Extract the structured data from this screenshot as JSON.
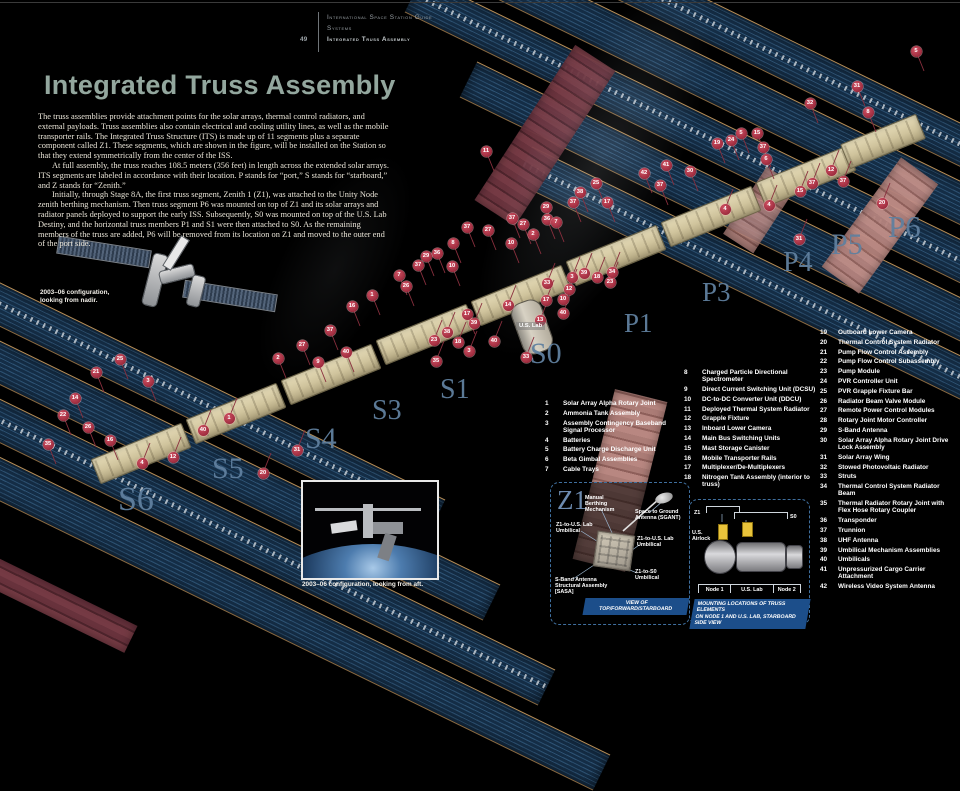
{
  "header": {
    "guide": "International Space Station Guide",
    "section": "Systems",
    "chapter": "Integrated Truss Assembly",
    "page": "49"
  },
  "title": "Integrated Truss Assembly",
  "intro": {
    "p1": "The truss assemblies provide attachment points for the solar arrays, thermal control radiators, and external payloads. Truss assemblies also contain electrical and cooling utility lines, as well as the mobile transporter rails. The Integrated Truss Structure (ITS) is made up of 11 segments plus a separate component called Z1. These segments, which are shown in the figure, will be installed on the Station so that they extend symmetrically from the center of the ISS.",
    "p2": "At full assembly, the truss reaches 108.5 meters (356 feet) in length across the extended solar arrays. ITS segments are labeled in accordance with their location. P stands for “port,” S stands for “starboard,” and Z stands for “Zenith.”",
    "p3": "Initially, through Stage 8A, the first truss segment, Zenith 1 (Z1), was attached to the Unity Node zenith berthing mechanism. Then truss segment P6 was mounted on top of Z1 and its solar arrays and radiator panels deployed to support the early ISS. Subsequently, S0 was mounted on top of the U.S. Lab Destiny, and the horizontal truss members P1 and S1 were then attached to S0. As the remaining members of the truss are added, P6 will be removed from its location on Z1 and moved to the outer end of the port side.",
    "caption_nadir": "2003–06 configuration, looking from nadir.",
    "caption_aft": "2003–06 configuration, looking from aft."
  },
  "diagram": {
    "us_lab_tag": "U.S. Lab",
    "segment_labels": [
      {
        "text": "S6",
        "x": 118,
        "y": 481,
        "size": 34
      },
      {
        "text": "S5",
        "x": 212,
        "y": 452,
        "size": 30
      },
      {
        "text": "S4",
        "x": 305,
        "y": 422,
        "size": 30
      },
      {
        "text": "S3",
        "x": 372,
        "y": 395,
        "size": 28
      },
      {
        "text": "S1",
        "x": 440,
        "y": 374,
        "size": 28
      },
      {
        "text": "S0",
        "x": 530,
        "y": 337,
        "size": 30
      },
      {
        "text": "P1",
        "x": 624,
        "y": 308,
        "size": 27
      },
      {
        "text": "P3",
        "x": 702,
        "y": 277,
        "size": 27
      },
      {
        "text": "P4",
        "x": 783,
        "y": 247,
        "size": 28
      },
      {
        "text": "P5",
        "x": 831,
        "y": 228,
        "size": 30
      },
      {
        "text": "P6",
        "x": 888,
        "y": 209,
        "size": 31
      }
    ],
    "badges": [
      {
        "n": "5",
        "x": 916,
        "y": 51
      },
      {
        "n": "31",
        "x": 857,
        "y": 86
      },
      {
        "n": "8",
        "x": 868,
        "y": 112
      },
      {
        "n": "32",
        "x": 810,
        "y": 103
      },
      {
        "n": "20",
        "x": 882,
        "y": 203
      },
      {
        "n": "37",
        "x": 843,
        "y": 181
      },
      {
        "n": "37",
        "x": 812,
        "y": 183
      },
      {
        "n": "15",
        "x": 800,
        "y": 191
      },
      {
        "n": "4",
        "x": 769,
        "y": 205
      },
      {
        "n": "31",
        "x": 799,
        "y": 239
      },
      {
        "n": "12",
        "x": 831,
        "y": 170
      },
      {
        "n": "15",
        "x": 757,
        "y": 133
      },
      {
        "n": "5",
        "x": 741,
        "y": 133
      },
      {
        "n": "24",
        "x": 731,
        "y": 140
      },
      {
        "n": "19",
        "x": 717,
        "y": 143
      },
      {
        "n": "37",
        "x": 763,
        "y": 147
      },
      {
        "n": "6",
        "x": 766,
        "y": 159
      },
      {
        "n": "30",
        "x": 690,
        "y": 171
      },
      {
        "n": "41",
        "x": 666,
        "y": 165
      },
      {
        "n": "42",
        "x": 644,
        "y": 173
      },
      {
        "n": "37",
        "x": 660,
        "y": 185
      },
      {
        "n": "4",
        "x": 725,
        "y": 209
      },
      {
        "n": "11",
        "x": 486,
        "y": 151
      },
      {
        "n": "25",
        "x": 596,
        "y": 183
      },
      {
        "n": "38",
        "x": 580,
        "y": 192
      },
      {
        "n": "37",
        "x": 573,
        "y": 202
      },
      {
        "n": "17",
        "x": 607,
        "y": 202
      },
      {
        "n": "29",
        "x": 546,
        "y": 207
      },
      {
        "n": "36",
        "x": 547,
        "y": 219
      },
      {
        "n": "7",
        "x": 556,
        "y": 222
      },
      {
        "n": "2",
        "x": 533,
        "y": 234
      },
      {
        "n": "27",
        "x": 523,
        "y": 224
      },
      {
        "n": "37",
        "x": 512,
        "y": 218
      },
      {
        "n": "10",
        "x": 511,
        "y": 243
      },
      {
        "n": "27",
        "x": 488,
        "y": 230
      },
      {
        "n": "37",
        "x": 467,
        "y": 227
      },
      {
        "n": "8",
        "x": 453,
        "y": 243
      },
      {
        "n": "36",
        "x": 437,
        "y": 253
      },
      {
        "n": "29",
        "x": 426,
        "y": 256
      },
      {
        "n": "10",
        "x": 452,
        "y": 266
      },
      {
        "n": "37",
        "x": 418,
        "y": 265
      },
      {
        "n": "7",
        "x": 399,
        "y": 275
      },
      {
        "n": "3",
        "x": 572,
        "y": 277
      },
      {
        "n": "39",
        "x": 584,
        "y": 273
      },
      {
        "n": "18",
        "x": 597,
        "y": 277
      },
      {
        "n": "23",
        "x": 610,
        "y": 282
      },
      {
        "n": "34",
        "x": 612,
        "y": 272
      },
      {
        "n": "12",
        "x": 569,
        "y": 289
      },
      {
        "n": "33",
        "x": 547,
        "y": 283
      },
      {
        "n": "14",
        "x": 508,
        "y": 305
      },
      {
        "n": "17",
        "x": 546,
        "y": 300
      },
      {
        "n": "10",
        "x": 563,
        "y": 299
      },
      {
        "n": "40",
        "x": 563,
        "y": 313
      },
      {
        "n": "17",
        "x": 467,
        "y": 314
      },
      {
        "n": "39",
        "x": 474,
        "y": 323
      },
      {
        "n": "38",
        "x": 447,
        "y": 332
      },
      {
        "n": "23",
        "x": 434,
        "y": 340
      },
      {
        "n": "18",
        "x": 458,
        "y": 342
      },
      {
        "n": "3",
        "x": 469,
        "y": 351
      },
      {
        "n": "35",
        "x": 436,
        "y": 361
      },
      {
        "n": "40",
        "x": 494,
        "y": 341
      },
      {
        "n": "33",
        "x": 526,
        "y": 357
      },
      {
        "n": "13",
        "x": 540,
        "y": 320
      },
      {
        "n": "16",
        "x": 352,
        "y": 306
      },
      {
        "n": "1",
        "x": 372,
        "y": 295
      },
      {
        "n": "26",
        "x": 406,
        "y": 286
      },
      {
        "n": "37",
        "x": 330,
        "y": 330
      },
      {
        "n": "27",
        "x": 302,
        "y": 345
      },
      {
        "n": "2",
        "x": 278,
        "y": 358
      },
      {
        "n": "9",
        "x": 318,
        "y": 362
      },
      {
        "n": "40",
        "x": 346,
        "y": 352
      },
      {
        "n": "21",
        "x": 96,
        "y": 372
      },
      {
        "n": "25",
        "x": 120,
        "y": 359
      },
      {
        "n": "3",
        "x": 148,
        "y": 381
      },
      {
        "n": "14",
        "x": 75,
        "y": 398
      },
      {
        "n": "22",
        "x": 63,
        "y": 415
      },
      {
        "n": "26",
        "x": 88,
        "y": 427
      },
      {
        "n": "16",
        "x": 110,
        "y": 440
      },
      {
        "n": "4",
        "x": 142,
        "y": 463
      },
      {
        "n": "12",
        "x": 173,
        "y": 457
      },
      {
        "n": "20",
        "x": 263,
        "y": 473
      },
      {
        "n": "31",
        "x": 297,
        "y": 450
      },
      {
        "n": "1",
        "x": 229,
        "y": 418
      },
      {
        "n": "40",
        "x": 203,
        "y": 430
      },
      {
        "n": "35",
        "x": 48,
        "y": 444
      }
    ]
  },
  "legend": {
    "col1": [
      {
        "n": "1",
        "label": "Solar Array Alpha Rotary Joint"
      },
      {
        "n": "2",
        "label": "Ammonia Tank Assembly"
      },
      {
        "n": "3",
        "label": "Assembly Contingency Baseband Signal Processor"
      },
      {
        "n": "4",
        "label": "Batteries"
      },
      {
        "n": "5",
        "label": "Battery Charge Discharge Unit"
      },
      {
        "n": "6",
        "label": "Beta Gimbal Assemblies"
      },
      {
        "n": "7",
        "label": "Cable Trays"
      }
    ],
    "col2": [
      {
        "n": "8",
        "label": "Charged Particle Directional Spectrometer"
      },
      {
        "n": "9",
        "label": "Direct Current Switching Unit (DCSU)"
      },
      {
        "n": "10",
        "label": "DC-to-DC Converter Unit (DDCU)"
      },
      {
        "n": "11",
        "label": "Deployed Thermal System Radiator"
      },
      {
        "n": "12",
        "label": "Grapple Fixture"
      },
      {
        "n": "13",
        "label": "Inboard Lower Camera"
      },
      {
        "n": "14",
        "label": "Main Bus Switching Units"
      },
      {
        "n": "15",
        "label": "Mast Storage Canister"
      },
      {
        "n": "16",
        "label": "Mobile Transporter Rails"
      },
      {
        "n": "17",
        "label": "Multiplexer/De-Multiplexers"
      },
      {
        "n": "18",
        "label": "Nitrogen Tank Assembly (interior to truss)"
      }
    ],
    "col3": [
      {
        "n": "19",
        "label": "Outboard Lower Camera"
      },
      {
        "n": "20",
        "label": "Thermal Control System Radiator"
      },
      {
        "n": "21",
        "label": "Pump Flow Control Assembly"
      },
      {
        "n": "22",
        "label": "Pump Flow Control Subassembly"
      },
      {
        "n": "23",
        "label": "Pump Module"
      },
      {
        "n": "24",
        "label": "PVR Controller Unit"
      },
      {
        "n": "25",
        "label": "PVR Grapple Fixture Bar"
      },
      {
        "n": "26",
        "label": "Radiator Beam Valve Module"
      },
      {
        "n": "27",
        "label": "Remote Power Control Modules"
      },
      {
        "n": "28",
        "label": "Rotary Joint Motor Controller"
      },
      {
        "n": "29",
        "label": "S-Band Antenna"
      },
      {
        "n": "30",
        "label": "Solar Array Alpha Rotary Joint Drive Lock Assembly"
      },
      {
        "n": "31",
        "label": "Solar Array Wing"
      },
      {
        "n": "32",
        "label": "Stowed Photovoltaic Radiator"
      },
      {
        "n": "33",
        "label": "Struts"
      },
      {
        "n": "34",
        "label": "Thermal Control System Radiator Beam"
      },
      {
        "n": "35",
        "label": "Thermal Radiator Rotary Joint with Flex Hose Rotary Coupler"
      },
      {
        "n": "36",
        "label": "Transponder"
      },
      {
        "n": "37",
        "label": "Trunnion"
      },
      {
        "n": "38",
        "label": "UHF Antenna"
      },
      {
        "n": "39",
        "label": "Umbilical Mechanism Assemblies"
      },
      {
        "n": "40",
        "label": "Umbilicals"
      },
      {
        "n": "41",
        "label": "Unpressurized Cargo Carrier Attachment"
      },
      {
        "n": "42",
        "label": "Wireless Video System Antenna"
      }
    ]
  },
  "z1_panel": {
    "title": "Z1",
    "callouts": {
      "mbm": "Manual Berthing Mechanism",
      "sgant": "Space to Ground Antenna (SGANT)",
      "umb_left": "Z1-to-U.S. Lab Umbilical",
      "umb_right": "Z1-to-U.S. Lab Umbilical",
      "umb_s0": "Z1-to-S0 Umbilical",
      "sasa": "S-Band Antenna Structural Assembly [SASA]"
    },
    "footer": "VIEW OF TOP/FORWARD/STARBOARD"
  },
  "node_panel": {
    "z1": "Z1",
    "s0": "S0",
    "airlock": "U.S. Airlock",
    "node1": "Node 1",
    "uslab": "U.S. Lab",
    "node2": "Node 2",
    "footer1": "MOUNTING LOCATIONS OF TRUSS ELEMENTS",
    "footer2": "ON NODE 1 AND U.S. LAB, STARBOARD SIDE VIEW"
  }
}
